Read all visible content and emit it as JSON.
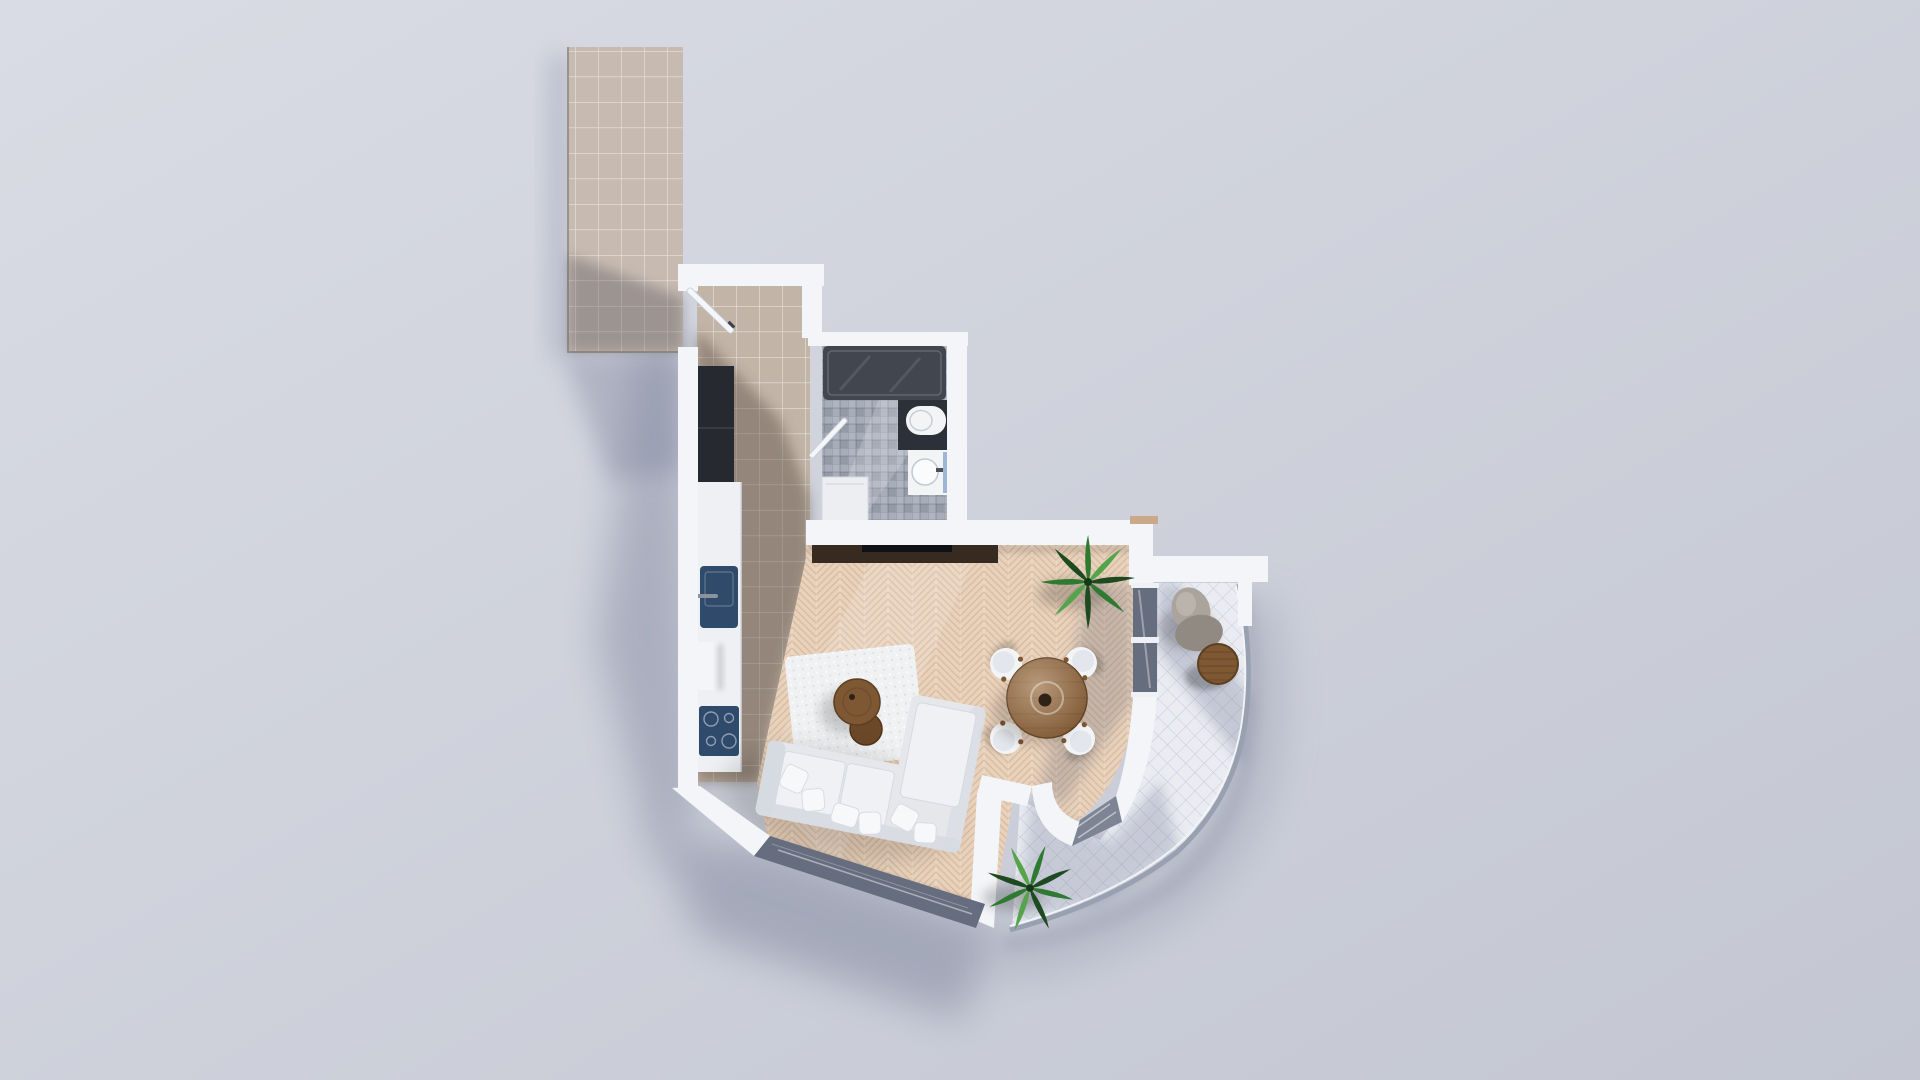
{
  "scene": {
    "type": "3d-floor-plan-top-view",
    "rooms": [
      {
        "id": "corridor",
        "label": "exterior tiled corridor"
      },
      {
        "id": "entry-hall",
        "label": "entry hall"
      },
      {
        "id": "bathroom",
        "label": "bathroom"
      },
      {
        "id": "kitchen",
        "label": "kitchen strip"
      },
      {
        "id": "living-dining",
        "label": "living and dining room"
      },
      {
        "id": "balcony",
        "label": "curved balcony"
      }
    ],
    "furniture": [
      "entry door",
      "hall wardrobe",
      "kitchen counter",
      "kitchen sink",
      "cooktop",
      "shower tray",
      "toilet",
      "vanity sink",
      "washing machine",
      "bathroom door",
      "tv console",
      "tv",
      "area rug",
      "coffee table large",
      "coffee table small",
      "l-shaped sofa",
      "sofa pillows",
      "dining table",
      "dining chair x4",
      "indoor plant",
      "balcony plant",
      "bean bag",
      "bistro table",
      "glass railing",
      "sliding glass door",
      "window band"
    ]
  },
  "colors": {
    "background": "#d5d8e1",
    "wall": "#f3f5f9",
    "wall_shade": "#dde1e9",
    "corridor_tile": "#c7bbb1",
    "corridor_edge": "#9a938b",
    "hall_tile": "#c2b4a7",
    "hall_shadow": "#554a3d",
    "wood": "#e9d2bc",
    "bath_floor": "#a8adba",
    "shower": "#41464f",
    "fixture_white": "#f2f4f6",
    "navy": "#2f4a6b",
    "wardrobe": "#26292f",
    "console": "#372b21",
    "tv": "#0f1114",
    "sofa": "#e5e7eb",
    "sofa_cushion": "#eff1f4",
    "sofa_shade": "#d6dae1",
    "pillow": "#f7f8fa",
    "rug": "#f0f1f3",
    "wood_table": "#7e5733",
    "wood_table_dark": "#5e3f22",
    "chair": "#f2f4f6",
    "balcony_tile": "#eaecf2",
    "glass": "#666d7e",
    "railing": "#99a0b0",
    "beanbag": "#aba49c",
    "beanbag_dark": "#918a82",
    "plant_dark": "#1d4a21",
    "plant_mid": "#2f7a33",
    "plant_light": "#55a44b",
    "shadow": "#7e849c",
    "vanity_accent": "#9db6d6"
  }
}
